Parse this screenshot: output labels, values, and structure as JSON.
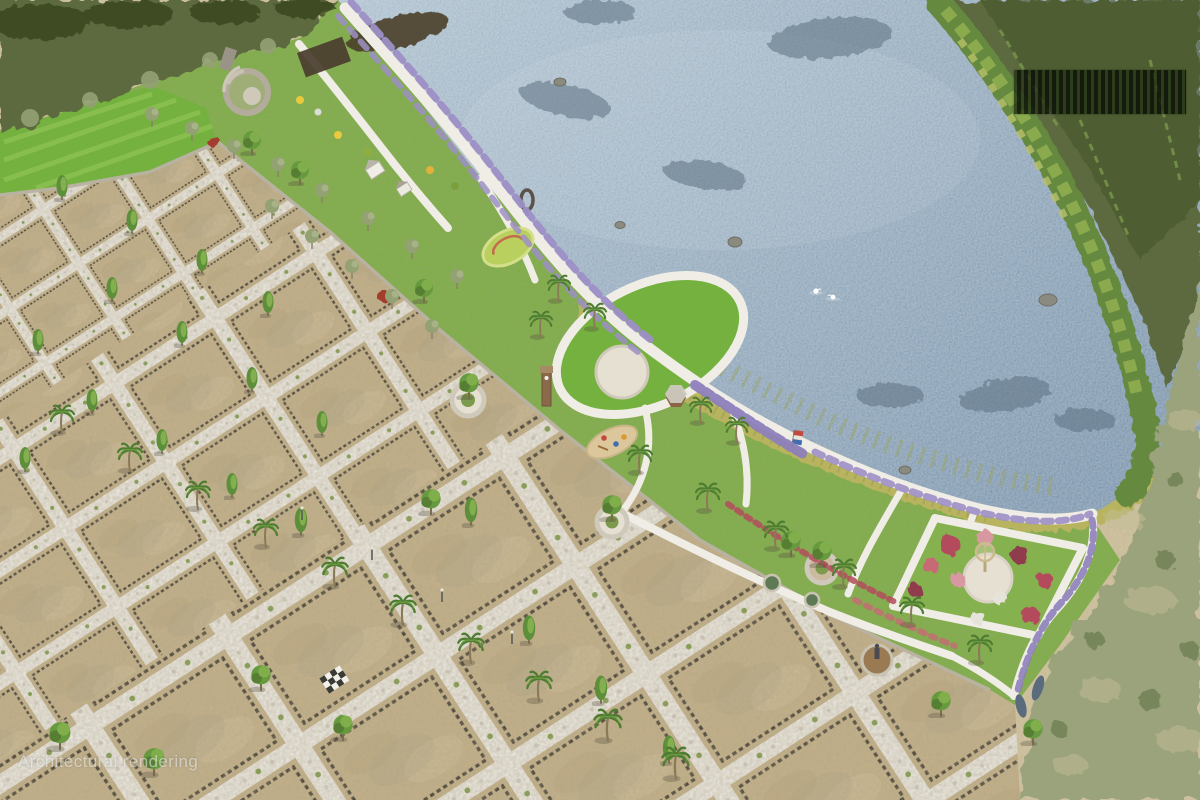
{
  "watermark": {
    "text": "Architectural rendering"
  },
  "colors": {
    "land": "#cfc3a0",
    "water1": "#aec1cf",
    "water2": "#7e97ae",
    "plot": "#c2b089",
    "road": "#e9e6de",
    "fence": "#4a4438",
    "lawn": "#7fae4a",
    "lawnBright": "#74b13e",
    "marsh": "#b7b35f",
    "scrub": "#9aa37b",
    "forest": "#5d6b3f",
    "forestDark": "#37441f",
    "bush": "#66893f",
    "flowerPurple": "#9d8fc6",
    "flowerRed": "#b44b5c",
    "flowerPink": "#d898a2",
    "path": "#efede5",
    "plaza": "#e6e0d2",
    "sand": "#dcc79c",
    "roofBrown": "#8a6444",
    "trunk": "#8a7a58",
    "palmGreen": "#4e7d32",
    "conifer": "#5d8f3a",
    "coniferLight": "#8fb754",
    "olive": "#93a173",
    "stone": "#b9b2a2",
    "weed": "#5d7181"
  }
}
